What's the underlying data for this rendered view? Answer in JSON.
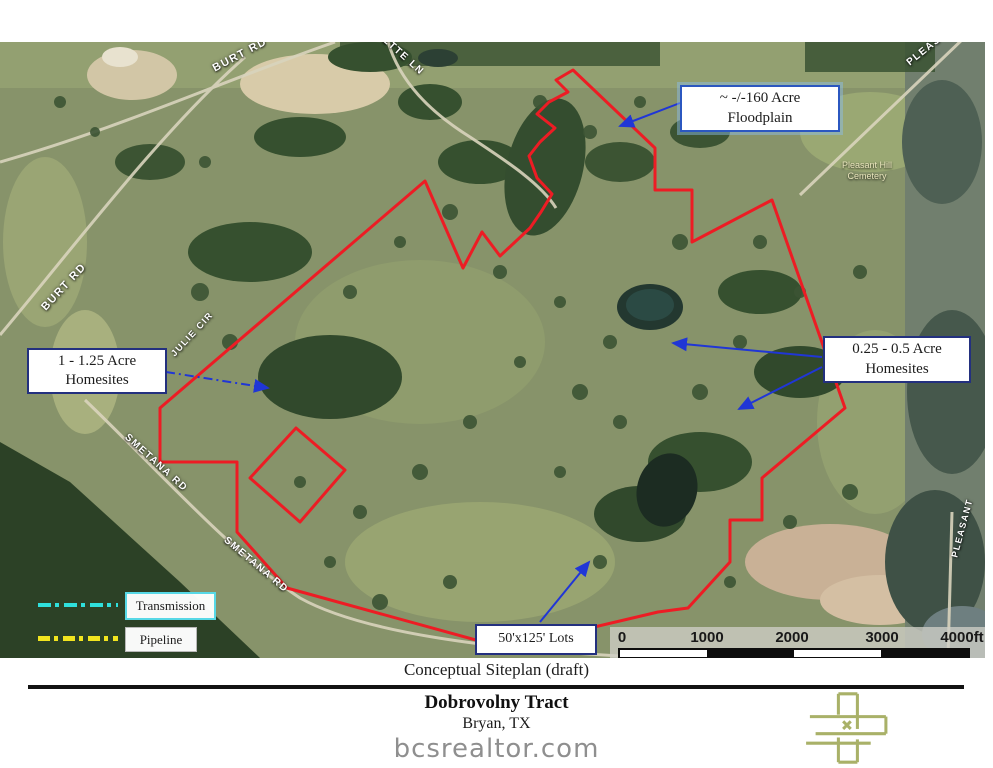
{
  "map": {
    "road_labels": [
      {
        "id": "burt-rd-top",
        "text": "BURT RD"
      },
      {
        "id": "ette-ln",
        "text": "ETTE LN"
      },
      {
        "id": "burt-rd-left",
        "text": "BURT RD"
      },
      {
        "id": "julie-cir",
        "text": "JULIE CIR"
      },
      {
        "id": "smetana-rd-upper",
        "text": "SMETANA RD"
      },
      {
        "id": "smetana-rd-lower",
        "text": "SMETANA RD"
      },
      {
        "id": "pleasant-top",
        "text": "PLEAS"
      },
      {
        "id": "pleasant-right",
        "text": "PLEASANT"
      }
    ],
    "poi": {
      "cemetery_line1": "Pleasant Hill",
      "cemetery_line2": "Cemetery"
    },
    "callouts": {
      "floodplain": {
        "line1": "~ -/-160 Acre",
        "line2": "Floodplain"
      },
      "homesites_large": {
        "line1": "1 - 1.25 Acre",
        "line2": "Homesites"
      },
      "homesites_small": {
        "line1": "0.25 - 0.5 Acre",
        "line2": "Homesites"
      },
      "lots": {
        "label": "50'x125' Lots"
      }
    },
    "legend": {
      "transmission_label": "Transmission",
      "pipeline_label": "Pipeline"
    },
    "scalebar": {
      "ticks": [
        "0",
        "1000",
        "2000",
        "3000",
        "4000ft"
      ]
    }
  },
  "footer": {
    "caption": "Conceptual Siteplan (draft)",
    "title": "Dobrovolny Tract",
    "subtitle": "Bryan, TX",
    "website": "bcsrealtor.com"
  },
  "colors": {
    "boundary_red": "#ed1c24",
    "annotation_blue": "#2036d6",
    "transmission_cyan": "#2fe0dc",
    "pipeline_yellow": "#f2e41f",
    "callout_border_navy": "#23307f",
    "logo_olive": "#a9b168"
  }
}
